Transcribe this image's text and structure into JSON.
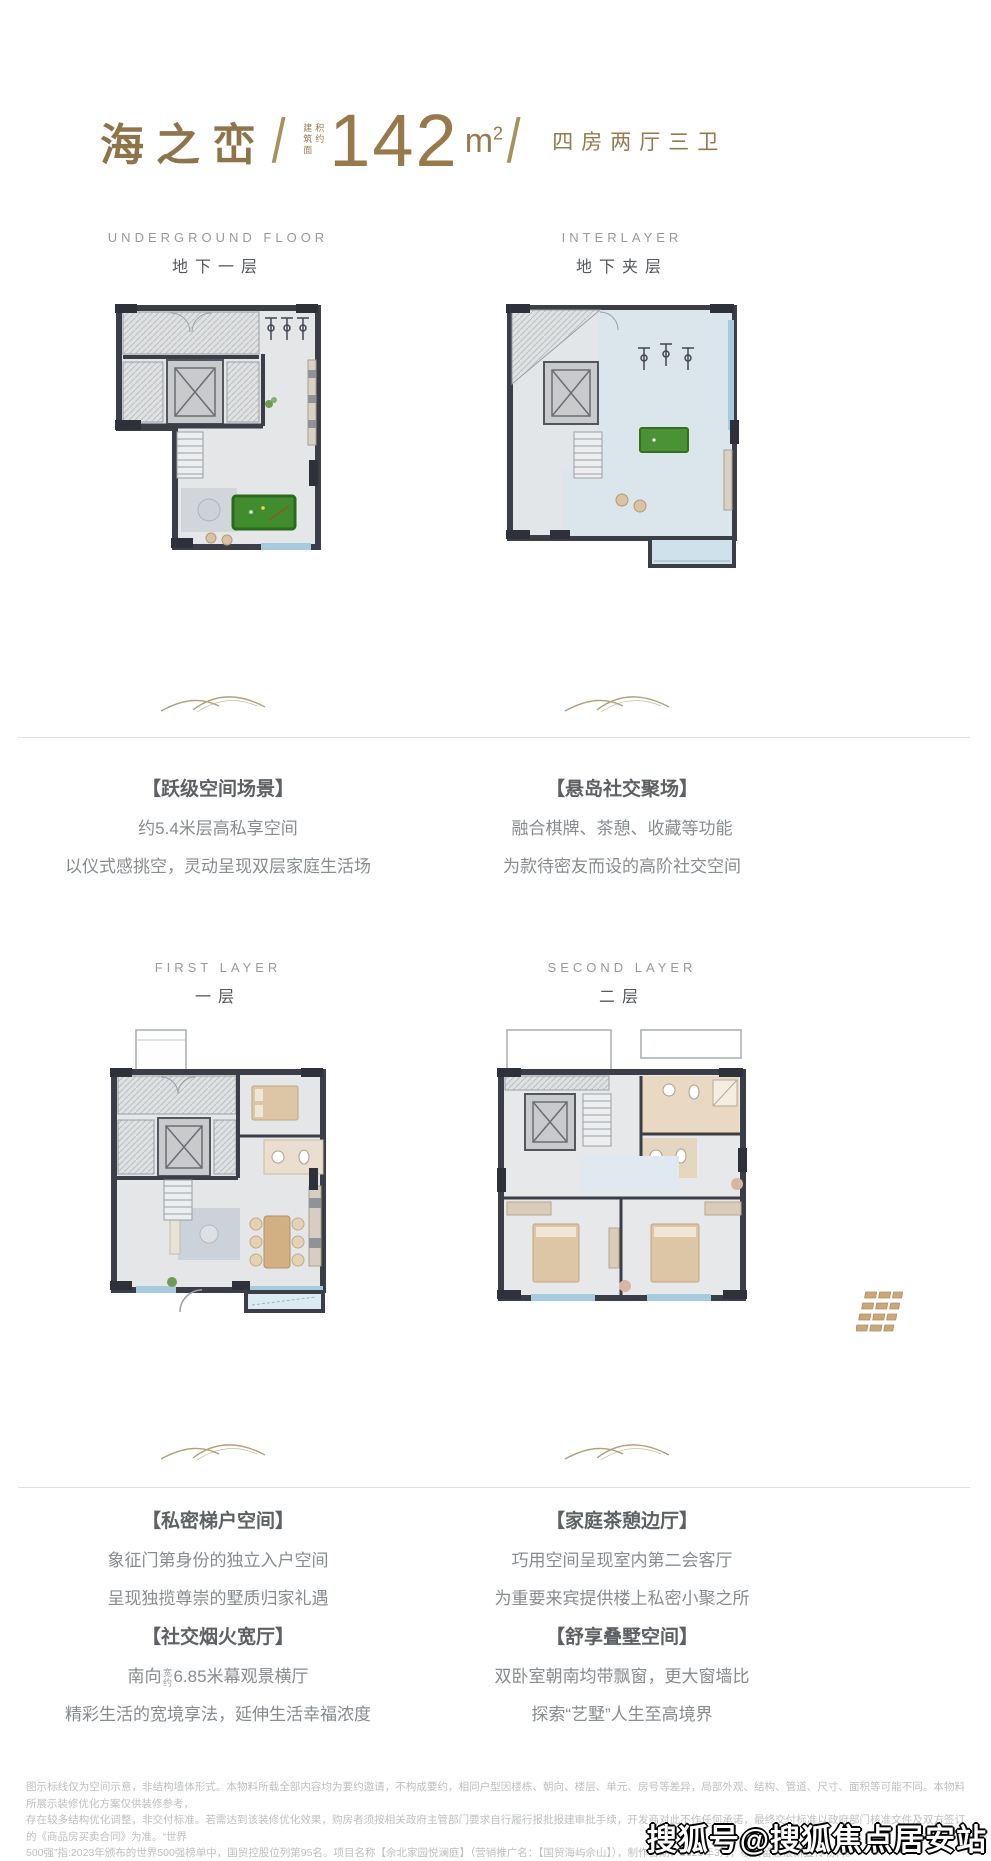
{
  "page": {
    "background": "#ffffff",
    "accent": "#97794c"
  },
  "header": {
    "project_name": "海之峦",
    "separator": "/",
    "area_prefix": "建筑面积约",
    "area_value": "142",
    "area_unit_base": "m",
    "area_unit_sup": "2",
    "layout_text": "四房两厅三卫"
  },
  "sections": {
    "underground": {
      "en": "UNDERGROUND FLOOR",
      "cn": "地下一层"
    },
    "interlayer": {
      "en": "INTERLAYER",
      "cn": "地下夹层"
    },
    "first": {
      "en": "FIRST LAYER",
      "cn": "一层"
    },
    "second": {
      "en": "SECOND LAYER",
      "cn": "二层"
    }
  },
  "features": [
    {
      "title": "【跃级空间场景】",
      "lines": [
        "约5.4米层高私享空间",
        "以仪式感挑空，灵动呈现双层家庭生活场"
      ]
    },
    {
      "title": "【悬岛社交聚场】",
      "lines": [
        "融合棋牌、茶憩、收藏等功能",
        "为款待密友而设的高阶社交空间"
      ]
    },
    {
      "title": "【私密梯户空间】",
      "lines": [
        "象征门第身份的独立入户空间",
        "呈现独揽尊崇的墅质归家礼遇"
      ]
    },
    {
      "title": "【社交烟火宽厅】",
      "line1_pre": "南向",
      "line1_small": "宽约",
      "line1_post": "6.85米幕观景横厅",
      "line2": "精彩生活的宽境享法，延伸生活幸福浓度"
    },
    {
      "title": "【家庭茶憩边厅】",
      "lines": [
        "巧用空间呈现室内第二会客厅",
        "为重要来宾提供楼上私密小聚之所"
      ]
    },
    {
      "title": "【舒享叠墅空间】",
      "lines": [
        "双卧室朝南均带飘窗，更大窗墙比",
        "探索“艺墅”人生至高境界"
      ]
    }
  ],
  "disclaimer": {
    "lines": [
      "图示标线仅为空间示意，非结构墙体形式。本物料所载全部内容均为要约邀请，不构成要约，相同户型因楼栋、朝向、楼层、单元、房号等差异，局部外观、结构、管道、尺寸、面积等可能不同。本物料所展示装修优化方案仅供装修参考，",
      "存在较多结构优化调整，非交付标准。若需达到该装修优化效果，购房者须按相关政府主管部门要求自行履行报批报建审批手续，开发商对此不作任何承诺，最终交付标准以政府部门核准文件及双方签订的《商品房买卖合同》为准。“世界",
      "500强”指:2023年颁布的世界500强榜单中，国贸控股位列第95名。项目名称【佘北家园悦澜庭】（营销推广名：【国贸海屿佘山】），制作日期：2025年3月，敬请留意最新宣传物料。"
    ]
  },
  "watermark": "搜狐号@搜狐焦点居安站"
}
